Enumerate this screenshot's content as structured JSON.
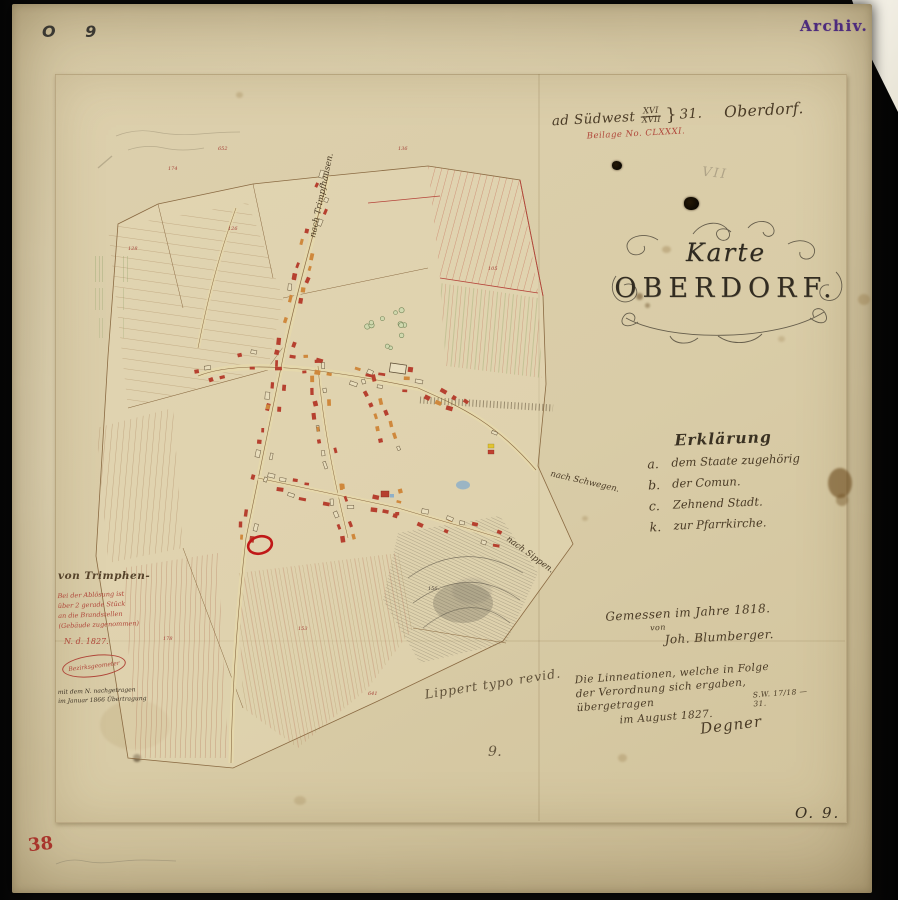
{
  "corner_marks": {
    "top_left": "O 9",
    "bottom_right": "O. 9.",
    "bottom_left_red": "38",
    "center_bottom": "9."
  },
  "archive_stamp": {
    "text": "Archiv.",
    "color": "#4d2b7d"
  },
  "header": {
    "prefix": "ad Südwest",
    "fraction_top": "XVI",
    "fraction_bottom": "XVII",
    "brace": "}",
    "number": "31.",
    "place": "Oberdorf.",
    "red_line": "Beilage No. CLXXXI.",
    "faint_mark": "VII"
  },
  "title": {
    "line1": "Karte",
    "line2": "OBERDORF."
  },
  "legend": {
    "title": "Erklärung",
    "items": [
      {
        "key": "a.",
        "label": "dem Staate zugehörig"
      },
      {
        "key": "b.",
        "label": "der Comun."
      },
      {
        "key": "c.",
        "label": "Zehnend Stadt."
      },
      {
        "key": "k.",
        "label": "zur Pfarrkirche."
      }
    ]
  },
  "survey_note": {
    "line1": "Gemessen im Jahre 1818.",
    "line2": "von",
    "line3": "Joh. Blumberger."
  },
  "transfer_note": {
    "line1": "Die Linneationen, welche in Folge",
    "line2": "der Verordnung sich ergaben,",
    "line3": "übergetragen",
    "line4": "im August 1827.",
    "signature": "Degner",
    "reference": "S.W. 17/18 — 31."
  },
  "revision_note": "Lippert typo revid.",
  "margin_note": {
    "heading": "von Trimphen-",
    "red_line1": "Bei der Ablösung ist",
    "red_line2": "über 2 gerade Stück",
    "red_line3": "an die Brandstellen",
    "red_line4": "(Gebäude zugenommen)",
    "red_date": "N. d. 1827.",
    "stamp_text": "Bezirksgeometer",
    "black_line1": "mit dem N. nachgetragen",
    "black_line2": "im Januar 1866 Übertragung"
  },
  "map": {
    "road_labels": [
      {
        "text": "nach Trimpfhausen."
      },
      {
        "text": "nach Schwegen."
      },
      {
        "text": "nach Sippen."
      }
    ],
    "parcel_numbers": [
      "156.",
      "174",
      "128",
      "652",
      "136",
      "105",
      "153",
      "178",
      "126",
      "641"
    ],
    "colors": {
      "line_brown": "#8a6a42",
      "parcel_red": "#b5443a",
      "green": "#6f8d4c",
      "building_red": "#b6402f",
      "building_orange": "#cf883c",
      "water_blue": "#8fb0c8",
      "highlight_red": "#c01818"
    }
  }
}
